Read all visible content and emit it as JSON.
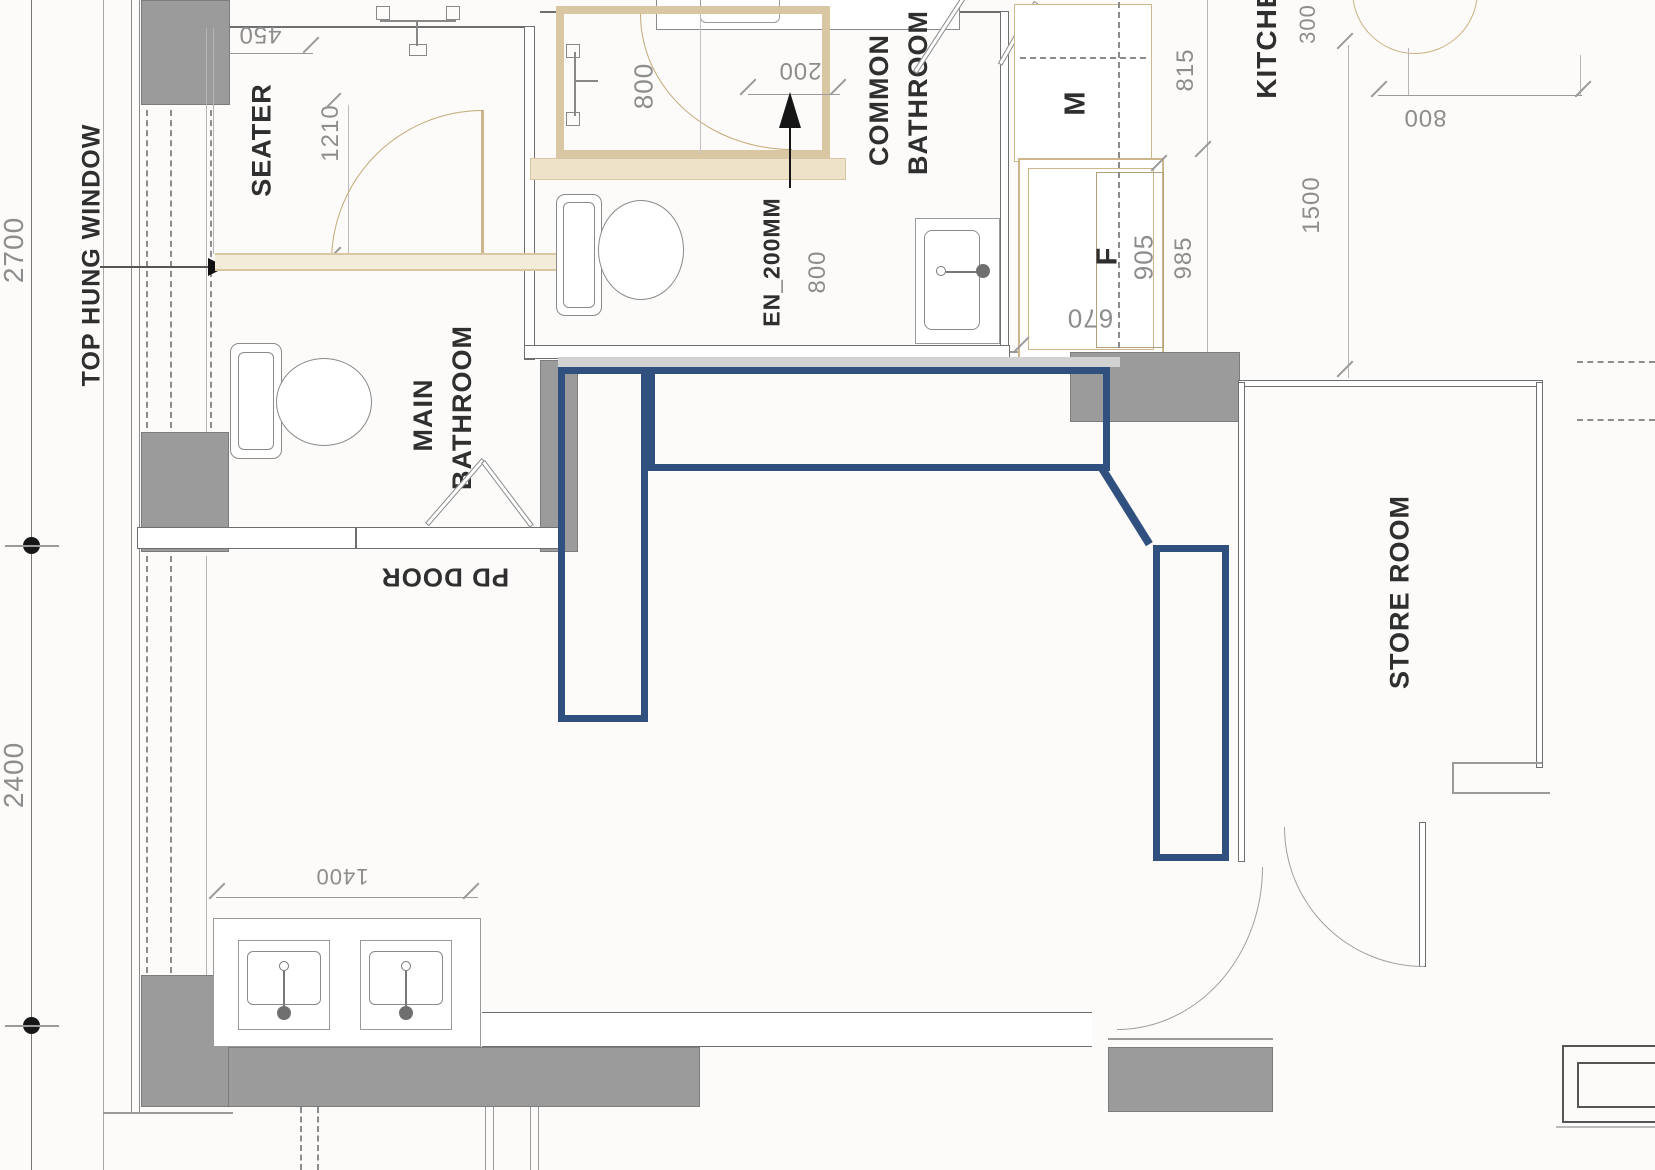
{
  "floorplan": {
    "rooms": {
      "seater": "SEATER",
      "main_bathroom": "MAIN BATHROOM",
      "common_bathroom": "COMMON BATHROOM",
      "kitchen": "KITCHEN",
      "store_room": "STORE ROOM"
    },
    "labels": {
      "top_hung_window": "TOP HUNG WINDOW",
      "pd_door": "PD DOOR",
      "screen": "EN_200MM",
      "wardrobe_m": "M",
      "wardrobe_f": "F"
    },
    "dims": {
      "d2700": "2700",
      "d2400": "2400",
      "d450": "450",
      "d1210": "1210",
      "d800_shower": "800",
      "d200": "200",
      "d800_screen": "800",
      "d815": "815",
      "d985": "985",
      "d905": "905",
      "d670": "670",
      "d300": "300",
      "d1500": "1500",
      "d800_kitchen": "800",
      "d1400": "1400"
    },
    "colors": {
      "highlight_blue": "#30507f",
      "wall_gray": "#9b9b9b",
      "door_tan": "#cdb68c",
      "dim_text": "#8d8d8d",
      "label_text": "#2f2f2f"
    }
  }
}
